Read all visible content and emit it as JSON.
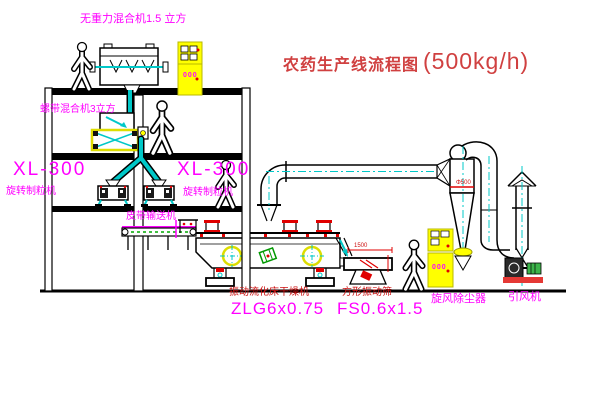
{
  "title": {
    "text": "农药生产线流程图",
    "capacity": "(500kg/h)"
  },
  "colors": {
    "label_magenta": "#ff00ff",
    "label_red": "#cc1111",
    "line_black": "#000000",
    "pipe_cyan": "#00c8c8",
    "cabinet_yellow": "#ffff00",
    "motor_green": "#3cb44a",
    "base_red": "#e53935"
  },
  "equipment": {
    "top_mixer": {
      "label": "无重力混合机1.5 立方"
    },
    "second_mixer": {
      "label": "螺带混合机3立方"
    },
    "granulator_left": {
      "model": "XL-300",
      "name": "旋转制粒机"
    },
    "granulator_right": {
      "model": "XL-300",
      "name": "旋转制粒机"
    },
    "belt_conveyor": {
      "label": "皮带输送机"
    },
    "dryer": {
      "name": "振动流化床干燥机",
      "model": "ZLG6x0.75"
    },
    "sieve": {
      "name": "方形振动筛",
      "model": "FS0.6x1.5",
      "dimension": "1500"
    },
    "cyclone": {
      "name": "旋风除尘器",
      "dimension": "Φ500"
    },
    "fan": {
      "name": "引风机"
    },
    "control_cabinet": {
      "display": "000"
    }
  }
}
